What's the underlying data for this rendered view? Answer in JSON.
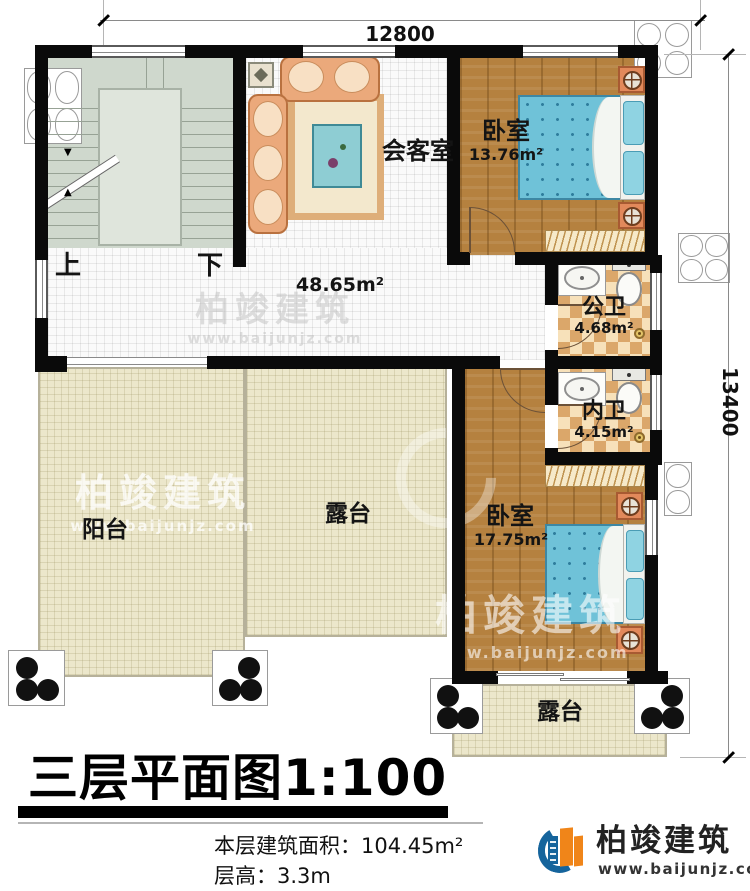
{
  "dimensions": {
    "width_top": "12800",
    "height_right": "13400"
  },
  "stairs": {
    "up": "上",
    "down": "下"
  },
  "hall": {
    "area": "48.65m²"
  },
  "rooms": {
    "meeting_room": {
      "name": "会客室"
    },
    "bedroom_top": {
      "name": "卧室",
      "area": "13.76m²"
    },
    "public_bath": {
      "name": "公卫",
      "area": "4.68m²"
    },
    "inner_bath": {
      "name": "内卫",
      "area": "4.15m²"
    },
    "bedroom_bottom": {
      "name": "卧室",
      "area": "17.75m²"
    },
    "balcony": {
      "name": "阳台"
    },
    "terrace_left": {
      "name": "露台"
    },
    "terrace_bottom": {
      "name": "露台"
    }
  },
  "footer": {
    "plan_title": "三层平面图",
    "plan_scale": "1:100",
    "area_label": "本层建筑面积：",
    "area_value": "104.45m²",
    "height_label": "层高：",
    "height_value": "3.3m"
  },
  "brand": {
    "name": "柏竣建筑",
    "website": "www.baijunjz.com"
  },
  "watermark": {
    "name": "柏竣建筑",
    "website": "www.baijunjz.com"
  }
}
